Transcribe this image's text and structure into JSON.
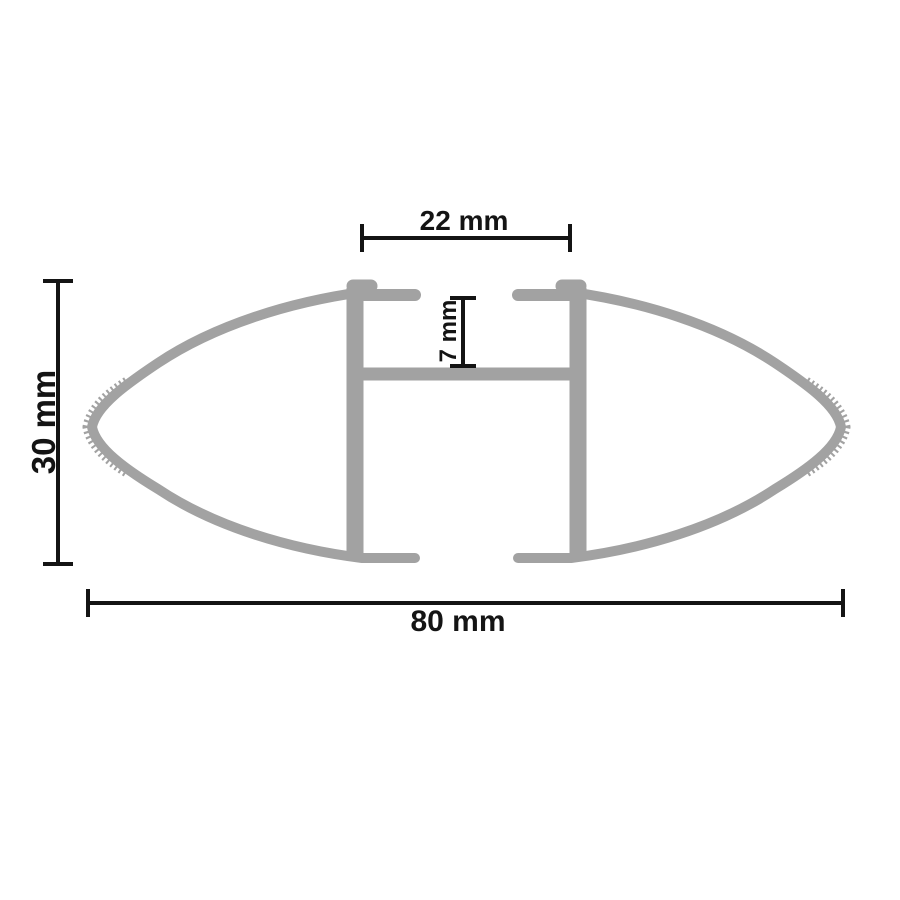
{
  "diagram": {
    "kind": "technical cross-section drawing",
    "subject": "roof crossbar aero profile",
    "background_color": "#ffffff",
    "profile_color": "#a2a2a2",
    "annotation_color": "#141414",
    "dimensions": {
      "slot_width": {
        "label": "22 mm",
        "value": 22,
        "unit": "mm"
      },
      "slot_depth": {
        "label": "7 mm",
        "value": 7,
        "unit": "mm"
      },
      "profile_height": {
        "label": "30 mm",
        "value": 30,
        "unit": "mm"
      },
      "profile_width": {
        "label": "80 mm",
        "value": 80,
        "unit": "mm"
      }
    }
  }
}
